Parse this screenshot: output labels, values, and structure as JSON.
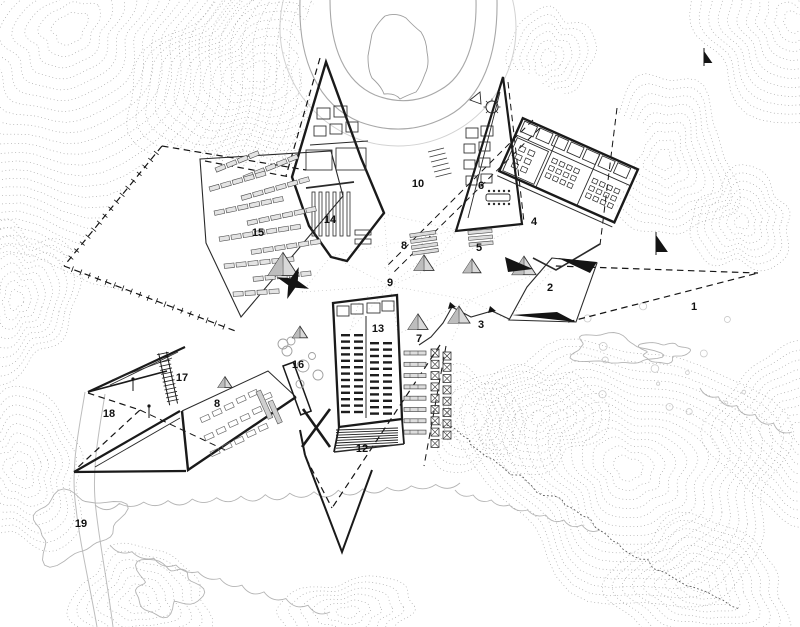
{
  "plan": {
    "figure_type": "architectural-site-plan",
    "colors": {
      "ink": "#141414",
      "wall": "#1a1a1a",
      "contour": "#9a9a9a",
      "contour_light": "#c3c3c3",
      "vegetation": "#b4b4b4",
      "rock_edge": "#5a5a5a",
      "marker_fill": "#d9d9d9",
      "marker_shade": "#bdbdbd",
      "background": "#ffffff"
    },
    "labels": [
      {
        "text": "1",
        "x": 694,
        "y": 310
      },
      {
        "text": "2",
        "x": 550,
        "y": 291
      },
      {
        "text": "3",
        "x": 481,
        "y": 328
      },
      {
        "text": "4",
        "x": 534,
        "y": 225
      },
      {
        "text": "5",
        "x": 479,
        "y": 251
      },
      {
        "text": "6",
        "x": 481,
        "y": 189
      },
      {
        "text": "7",
        "x": 419,
        "y": 342
      },
      {
        "text": "8",
        "x": 404,
        "y": 249
      },
      {
        "text": "8",
        "x": 217,
        "y": 407
      },
      {
        "text": "9",
        "x": 390,
        "y": 286
      },
      {
        "text": "10",
        "x": 418,
        "y": 187
      },
      {
        "text": "12",
        "x": 362,
        "y": 452
      },
      {
        "text": "13",
        "x": 378,
        "y": 332
      },
      {
        "text": "14",
        "x": 330,
        "y": 223
      },
      {
        "text": "15",
        "x": 258,
        "y": 236
      },
      {
        "text": "16",
        "x": 298,
        "y": 368
      },
      {
        "text": "17",
        "x": 182,
        "y": 381
      },
      {
        "text": "18",
        "x": 109,
        "y": 417
      },
      {
        "text": "19",
        "x": 81,
        "y": 527
      }
    ],
    "markers": {
      "pyramid_tents": [
        {
          "x": 283,
          "y": 266,
          "s": 30
        },
        {
          "x": 424,
          "y": 264,
          "s": 20
        },
        {
          "x": 472,
          "y": 267,
          "s": 18
        },
        {
          "x": 524,
          "y": 267,
          "s": 24
        },
        {
          "x": 418,
          "y": 323,
          "s": 20
        },
        {
          "x": 459,
          "y": 316,
          "s": 22
        },
        {
          "x": 225,
          "y": 383,
          "s": 14
        },
        {
          "x": 300,
          "y": 333,
          "s": 15
        }
      ],
      "star_sculpture": {
        "x": 293,
        "y": 283,
        "s": 17
      },
      "sail_flags": [
        {
          "x": 656,
          "y": 252,
          "s": 17
        },
        {
          "x": 704,
          "y": 63,
          "s": 12
        }
      ],
      "arrow_pointer": {
        "x": 505,
        "y": 257
      },
      "poles": [
        {
          "x": 133,
          "y": 385
        },
        {
          "x": 149,
          "y": 412
        }
      ]
    }
  }
}
